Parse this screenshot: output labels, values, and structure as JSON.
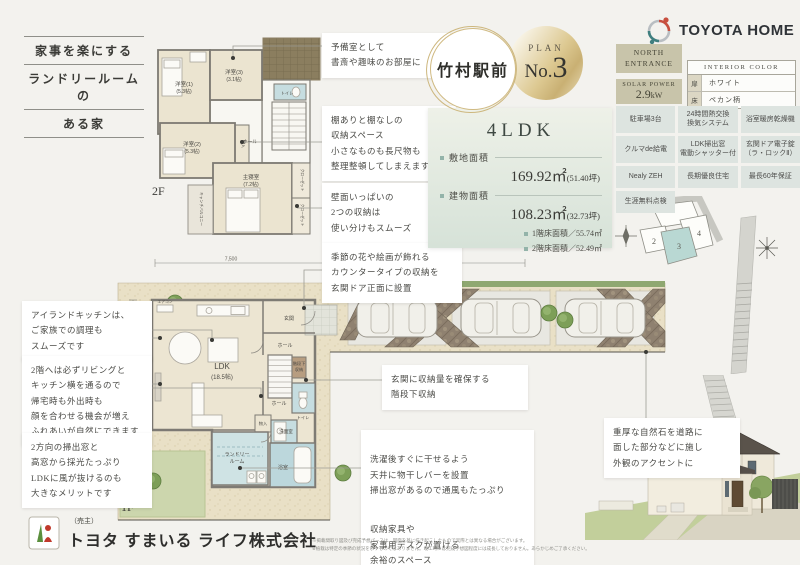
{
  "tagline": {
    "l1": "家事を楽にする",
    "l2": "ランドリールームの",
    "l3": "ある家"
  },
  "brand": {
    "name": "TOYOTA HOME"
  },
  "plan_circle": {
    "location": "竹村駅前",
    "plan_label": "PLAN",
    "no_prefix": "No.",
    "no_digit": "3"
  },
  "summary": {
    "ldk": "4LDK",
    "site_label": "敷地面積",
    "site_value": "169.92㎡",
    "site_tsubo": "(51.40坪)",
    "bldg_label": "建物面積",
    "bldg_value": "108.23㎡",
    "bldg_tsubo": "(32.73坪)",
    "floor1": "1階床面積／55.74㎡",
    "floor2": "2階床面積／52.49㎡"
  },
  "badges": {
    "north": "NORTH\nENTRANCE",
    "solar_label": "SOLAR POWER",
    "solar_value": "2.9",
    "solar_unit": "kW"
  },
  "interior": {
    "title": "INTERIOR COLOR",
    "r1_label": "扉",
    "r1_value": "ホワイト",
    "r2_label": "床",
    "r2_value": "ペカン柄"
  },
  "features": [
    "駐車場3台",
    "24時間熱交換\n換気システム",
    "浴室暖房乾燥機",
    "クルマde給電",
    "LDK掃出窓\n電動シャッター付",
    "玄関ドア電子錠\n（ラ・ロックⅡ）",
    "Nealy ZEH",
    "長期優良住宅",
    "最長60年保証",
    "生涯無料点検"
  ],
  "lot_map": {
    "title": "■ 区画図",
    "lot2": "2",
    "lot3": "3",
    "lot4": "4"
  },
  "f2": {
    "label": "2F",
    "r1_name": "洋室(1)",
    "r1_size": "(5.3帖)",
    "r3_name": "洋室(3)",
    "r3_size": "(3.1帖)",
    "r2_name": "洋室(2)",
    "r2_size": "(5.3帖)",
    "master_name": "主寝室",
    "master_size": "(7.2帖)",
    "toilet": "トイレ",
    "hall": "ホール",
    "storage": "物入",
    "closet1": "クローゼット",
    "closet2": "クローゼット",
    "balcony": "キャンチバルコニー"
  },
  "f1": {
    "label": "1F",
    "ldk_name": "LDK",
    "ldk_size": "(18.5帖)",
    "entrance": "玄関",
    "hall1": "ホール",
    "hall2": "ホール",
    "stair_storage1": "階段下",
    "stair_storage2": "収納",
    "toilet": "トイレ",
    "storage": "物入",
    "washroom": "洗面室",
    "laundry1": "ランドリー",
    "laundry2": "ルーム",
    "bath": "浴室",
    "aircon": "エアコン",
    "dim_w": "7,500",
    "dim_h": "8,750"
  },
  "callouts": {
    "reserve": "予備室として\n書斎や趣味のお部屋に",
    "shelves": "棚ありと棚なしの\n収納スペース\n小さなものも長尺物も\n整理整頓してしまえます",
    "wall_storage": "壁面いっぱいの\n2つの収納は\n使い分けもスムーズ",
    "counter": "季節の花や絵画が飾れる\nカウンタータイプの収納を\n玄関ドア正面に設置",
    "island": "アイランドキッチンは、\nご家族での調理も\nスムーズです",
    "stair_path": "2階へは必ずリビングと\nキッチン横を通るので\n帰宅時も外出時も\n顔を合わせる機会が増え\nふれあいが自然にできます",
    "windows": "2方向の掃出窓と\n高窓から採光たっぷり\nLDKに風が抜けるのも\n大きなメリットです",
    "under_stairs": "玄関に収納量を確保する\n階段下収納",
    "laundry_bar": "洗濯後すぐに干せるよう\n天井に物干しバーを設置\n掃出窓があるので通風もたっぷり",
    "desk_space": "収納家具や\n家事用デスクが置ける\n余裕のスペース",
    "stone": "重厚な自然石を道路に\n面した部分などに施し\n外観のアクセントに"
  },
  "footer": {
    "seller": "（売主）",
    "company": "トヨタ すまいる ライフ株式会社",
    "disclaimer": "※掲載間取り図及び完成予想パースは、図面を基に描き起こしたもので実際とは異なる場合がございます。\n※植栽は特定の季節の状況を示すものではありません。竣工時には完成予想図程度には成長しておりません。あらかじめご了承ください。"
  }
}
